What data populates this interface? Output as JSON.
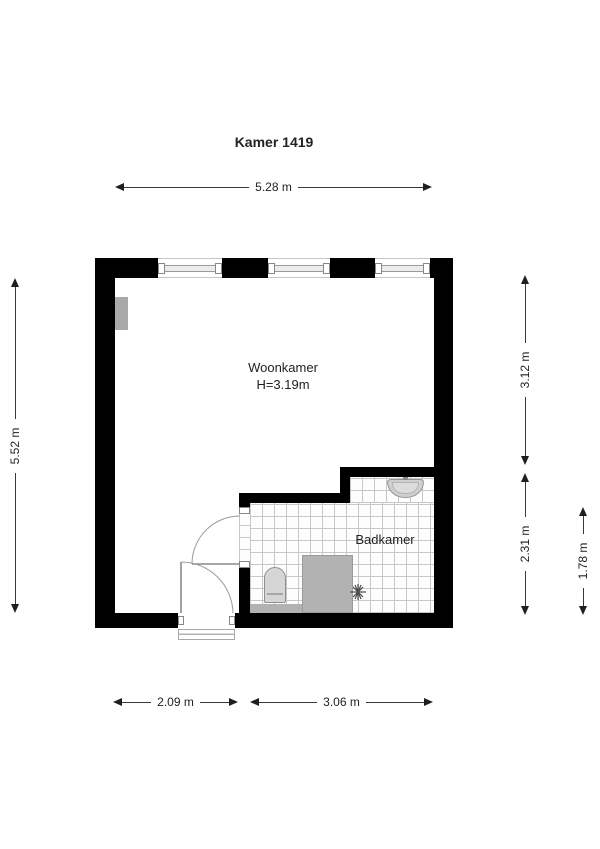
{
  "title": "Kamer 1419",
  "rooms": {
    "living": {
      "name": "Woonkamer",
      "ceiling_height": "H=3.19m"
    },
    "bath": {
      "name": "Badkamer"
    }
  },
  "dimensions": {
    "top_width": "5.28 m",
    "left_height": "5.52 m",
    "right_upper": "3.12 m",
    "right_lower": "2.31 m",
    "right_inner": "1.78 m",
    "bottom_left": "2.09 m",
    "bottom_right": "3.06 m"
  },
  "fixtures": {
    "toilet": "toilet",
    "shower": "shower-tray",
    "sink": "washbasin",
    "radiator": "radiator",
    "drain": "shower-drain"
  },
  "colors": {
    "wall": "#000000",
    "tile_line": "#c7c7c7",
    "fixture_gray": "#b2b2b2",
    "dimension_text": "#1f1f1f"
  }
}
